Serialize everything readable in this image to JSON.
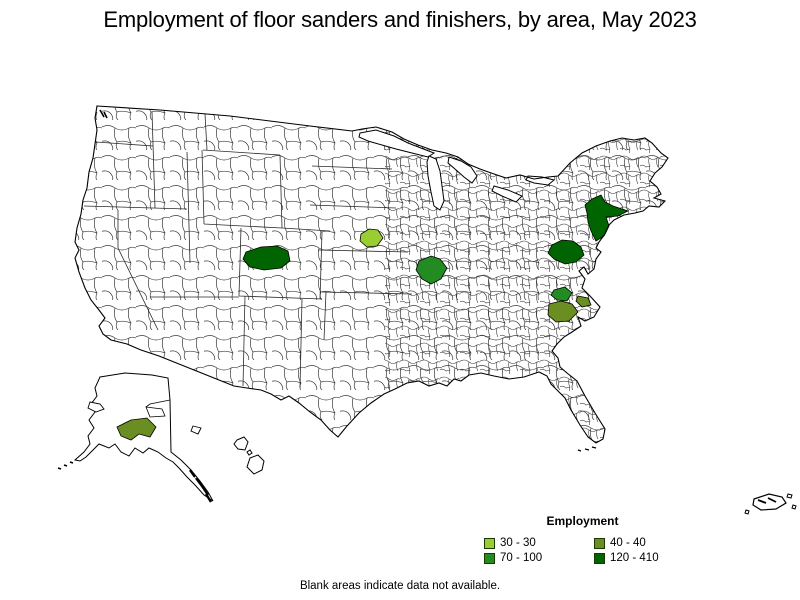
{
  "title": "Employment of floor sanders and finishers, by area, May 2023",
  "footnote": "Blank areas indicate data not available.",
  "legend": {
    "title": "Employment",
    "items": [
      {
        "label": "30 - 30",
        "color": "#9ACD32"
      },
      {
        "label": "40 - 40",
        "color": "#6B8E23"
      },
      {
        "label": "70 - 100",
        "color": "#228B22"
      },
      {
        "label": "120 - 410",
        "color": "#006400"
      }
    ]
  },
  "map": {
    "land_fill": "#FFFFFF",
    "boundary_color": "#000000",
    "areas": [
      {
        "region": "central-colorado",
        "value_range": "120 - 410",
        "color": "#006400"
      },
      {
        "region": "eastern-nebraska",
        "value_range": "30 - 30",
        "color": "#9ACD32"
      },
      {
        "region": "st-louis-missouri-illinois",
        "value_range": "70 - 100",
        "color": "#228B22"
      },
      {
        "region": "new-york-metro",
        "value_range": "120 - 410",
        "color": "#006400"
      },
      {
        "region": "washington-baltimore",
        "value_range": "120 - 410",
        "color": "#006400"
      },
      {
        "region": "richmond-virginia",
        "value_range": "70 - 100",
        "color": "#228B22"
      },
      {
        "region": "hampton-roads-virginia",
        "value_range": "40 - 40",
        "color": "#6B8E23"
      },
      {
        "region": "coastal-virginia-spot",
        "value_range": "40 - 40",
        "color": "#6B8E23"
      },
      {
        "region": "southcentral-alaska",
        "value_range": "40 - 40",
        "color": "#6B8E23"
      }
    ]
  }
}
